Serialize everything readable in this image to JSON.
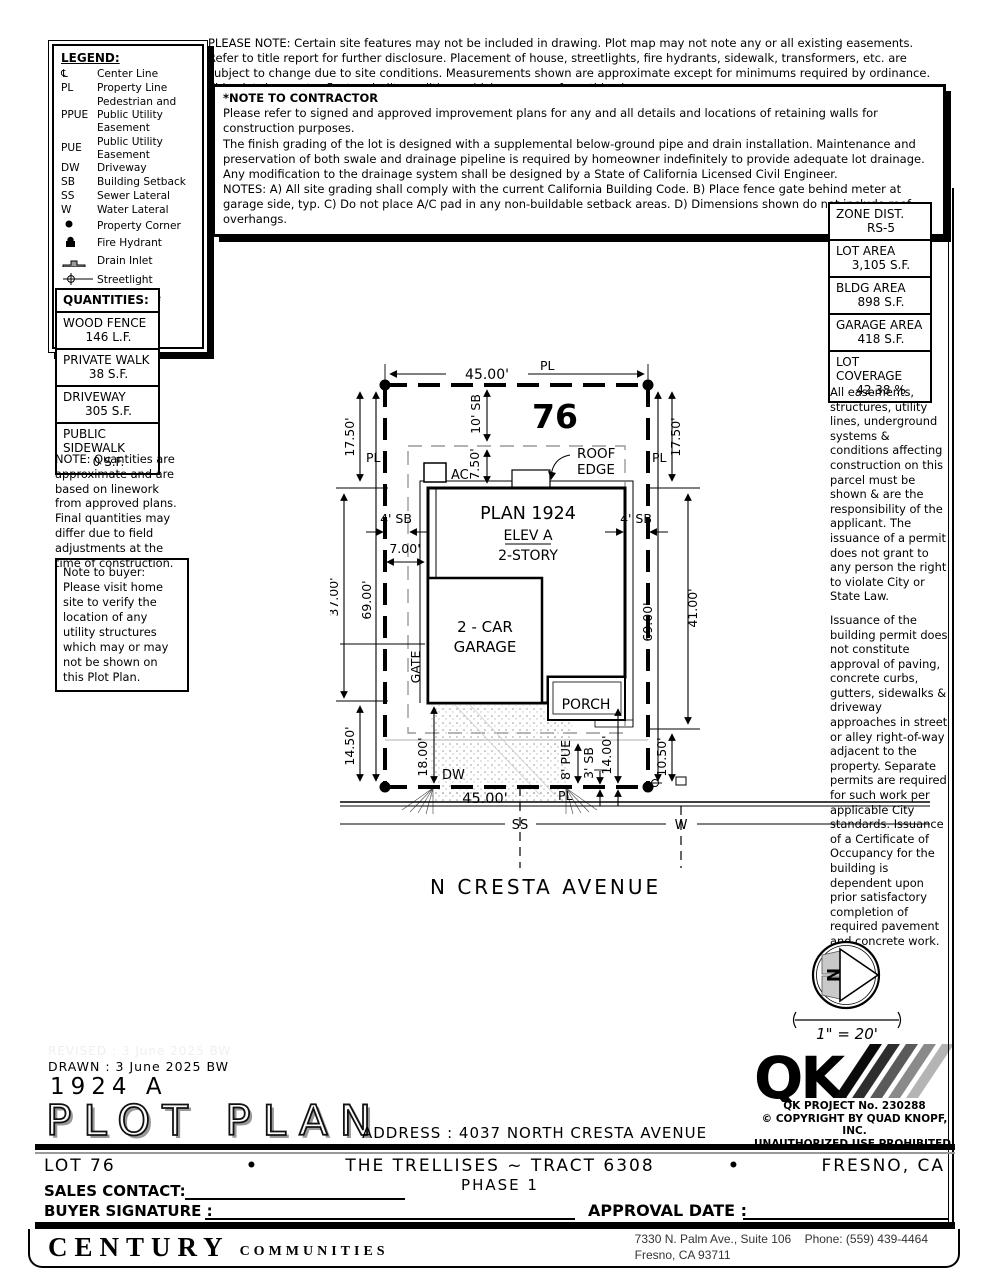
{
  "legend": {
    "title": "LEGEND:",
    "items": [
      {
        "symbol": "℄",
        "label": "Center Line"
      },
      {
        "symbol": "PL",
        "label": "Property Line"
      },
      {
        "symbol": "PPUE",
        "label": "Pedestrian and Public Utility Easement"
      },
      {
        "symbol": "PUE",
        "label": "Public Utility Easement"
      },
      {
        "symbol": "DW",
        "label": "Driveway"
      },
      {
        "symbol": "SB",
        "label": "Building Setback"
      },
      {
        "symbol": "SS",
        "label": "Sewer Lateral"
      },
      {
        "symbol": "W",
        "label": "Water Lateral"
      },
      {
        "symbol": "",
        "label": "Property Corner"
      },
      {
        "symbol": "",
        "label": "Fire Hydrant"
      },
      {
        "symbol": "",
        "label": "Drain Inlet"
      },
      {
        "symbol": "",
        "label": "Streetlight"
      },
      {
        "symbol": "",
        "label": "Wood Fence"
      },
      {
        "symbol": "",
        "label": "Block Wall"
      },
      {
        "symbol": "",
        "label": "Concrete"
      }
    ]
  },
  "top_note": "PLEASE NOTE:  Certain site features may not be included in drawing.  Plot map may not note any or all existing easements. Refer to title report for further disclosure.  Placement of house, streetlights, fire hydrants, sidewalk, transformers, etc. are subject to change due to site conditions.  Measurements shown are approximate except for minimums required by ordinance.  This plot does not reflect as-built conditions which may vary from this plan.",
  "contractor_note": {
    "title": "*NOTE TO CONTRACTOR",
    "p1": "Please refer to signed and approved improvement plans for any and all details and locations of retaining walls for construction purposes.",
    "p2": "The finish grading of the lot is designed with a supplemental below-ground pipe and drain installation.  Maintenance and preservation of both swale and drainage pipeline is required by homeowner indefinitely to provide adequate lot drainage.  Any modification to the drainage system shall be designed by a State of California Licensed Civil Engineer.",
    "p3": "NOTES:  A) All site grading shall comply with the current California Building Code.  B) Place fence gate behind meter at garage side, typ.  C) Do not place A/C pad in any non-buildable setback areas.  D) Dimensions shown do not include roof overhangs."
  },
  "stats": {
    "rows": [
      {
        "label": "ZONE DIST.",
        "value": "RS-5"
      },
      {
        "label": "LOT AREA",
        "value": "3,105 S.F."
      },
      {
        "label": "BLDG AREA",
        "value": "898 S.F."
      },
      {
        "label": "GARAGE AREA",
        "value": "418 S.F."
      },
      {
        "label": "LOT COVERAGE",
        "value": "42.38 %"
      }
    ]
  },
  "right_notes": {
    "p1": "All easements, structures, utility lines, underground systems & conditions affecting construction on this parcel must be shown & are the responsibility of the applicant. The issuance of a permit does not grant to any person the right to violate City or State Law.",
    "p2": "Issuance of the building permit does not constitute approval of paving, concrete curbs, gutters, sidewalks & driveway approaches in street or alley right-of-way adjacent to the property. Separate permits are required for such work per applicable City standards. Issuance of a Certificate of Occupancy for the building is dependent upon prior satisfactory completion of required pavement and concrete work."
  },
  "quantities": {
    "title": "QUANTITIES:",
    "rows": [
      {
        "label": "WOOD FENCE",
        "value": "146 L.F."
      },
      {
        "label": "PRIVATE WALK",
        "value": "38 S.F."
      },
      {
        "label": "DRIVEWAY",
        "value": "305 S.F."
      },
      {
        "label": "PUBLIC SIDEWALK",
        "value": "0 S.F."
      }
    ],
    "note": "NOTE: Quantities are approximate and are based on linework from approved plans.  Final quantities may differ due to field adjustments at the time of construction."
  },
  "buyer_note": "Note to buyer: Please visit home site to verify the location of any utility structures which may or may not be shown on this Plot Plan.",
  "plot": {
    "lot_number": "76",
    "pl": "PL",
    "plan_line1": "PLAN 1924",
    "plan_line2": "ELEV A",
    "plan_line3": "2-STORY",
    "garage_line1": "2 - CAR",
    "garage_line2": "GARAGE",
    "porch": "PORCH",
    "roof_edge1": "ROOF",
    "roof_edge2": "EDGE",
    "ac": "AC",
    "gate": "GATE",
    "dw": "DW",
    "ss": "SS",
    "w": "W",
    "street": "N CRESTA AVENUE",
    "dim_top": "45.00'",
    "dim_bottom": "45.00'",
    "dim_left_outer_top": "17.50'",
    "dim_left_mid": "37.00'",
    "dim_left_bottom": "14.50'",
    "dim_left_inner": "69.00'",
    "dim_right_outer_top": "17.50'",
    "dim_right_mid": "41.00'",
    "dim_right_bottom": "10.50'",
    "dim_right_inner": "69.00'",
    "dim_front_sb": "10' SB",
    "dim_roof_offset": "7.50'",
    "dim_side_sb_left": "4' SB",
    "dim_side_sb_right": "4' SB",
    "dim_7": "7.00'",
    "dim_drive": "18.00'",
    "dim_pue": "8' PUE",
    "dim_rear_sb": "3' SB",
    "dim_14": "14.00'"
  },
  "north": {
    "n": "N",
    "scale": "1\" = 20'"
  },
  "titleblock": {
    "revised": "REVISED :  3 June 2025  BW",
    "drawn": "DRAWN :  3 June 2025  BW",
    "plan_code": "1924  A",
    "title": "PLOT PLAN",
    "address": "ADDRESS :  4037 NORTH CRESTA AVENUE"
  },
  "qk": {
    "logo": "QK",
    "project": "QK PROJECT No. 230288",
    "copyright": "©  COPYRIGHT BY QUAD KNOPF, INC.",
    "prohibited": "UNAUTHORIZED USE PROHIBITED."
  },
  "footer": {
    "lot": "LOT 76",
    "bullet": "•",
    "tract": "THE TRELLISES ~ TRACT 6308",
    "phase": "PHASE 1",
    "city": "FRESNO, CA",
    "sales_contact": "SALES CONTACT:",
    "buyer_signature": "BUYER SIGNATURE :",
    "approval_date": "APPROVAL DATE :",
    "brand": "CENTURY",
    "brand2": "COMMUNITIES",
    "addr1": "7330 N. Palm Ave., Suite 106",
    "phone": "Phone:  (559) 439-4464",
    "addr2": "Fresno, CA  93711"
  }
}
